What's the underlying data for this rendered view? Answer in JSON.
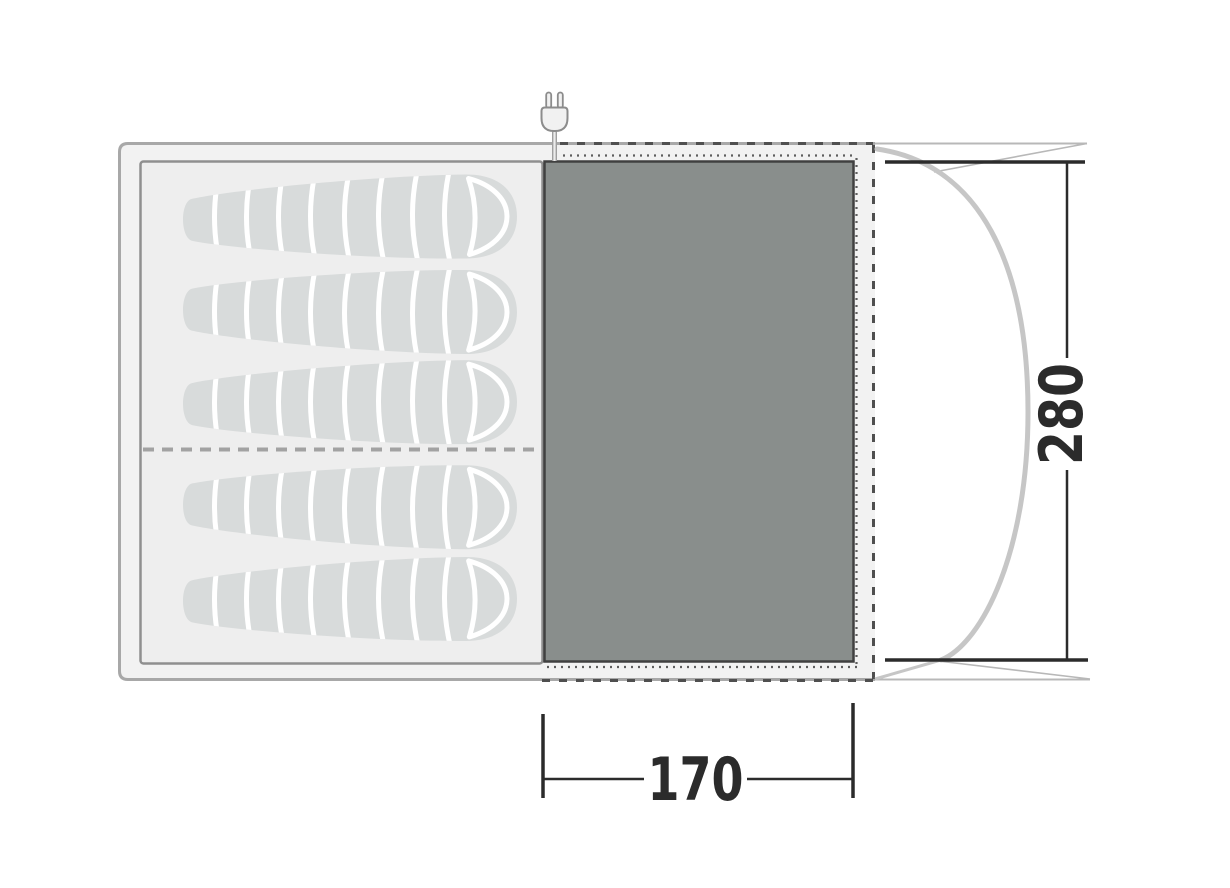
{
  "diagram": {
    "type": "tent-floorplan-top-view",
    "dimensions": {
      "depth": {
        "label": "280",
        "orientation": "vertical"
      },
      "living_width": {
        "label": "170",
        "orientation": "horizontal"
      }
    },
    "areas": {
      "sleeping_cabin": {
        "sleeping_bag_count": 5,
        "rows": [
          3,
          2
        ]
      },
      "living_area": {},
      "porch": {}
    },
    "icons": [
      {
        "name": "power-plug-icon"
      }
    ],
    "colors": {
      "tent_fill": "#f2f2f2",
      "tent_outline": "#a8a8a8",
      "cabin_fill": "#eeeeee",
      "cabin_outline": "#8f8f8f",
      "sleeping_bag_fill": "#d8dbdb",
      "living_area_fill": "#898e8c",
      "living_area_outline": "#404040",
      "dashed_line": "#4f4f4f",
      "dotted_line": "#5e5e5e",
      "porch_line": "#b8b8b8",
      "porch_pole": "#c6c6c6",
      "dimension_ink": "#2b2b2b"
    }
  }
}
